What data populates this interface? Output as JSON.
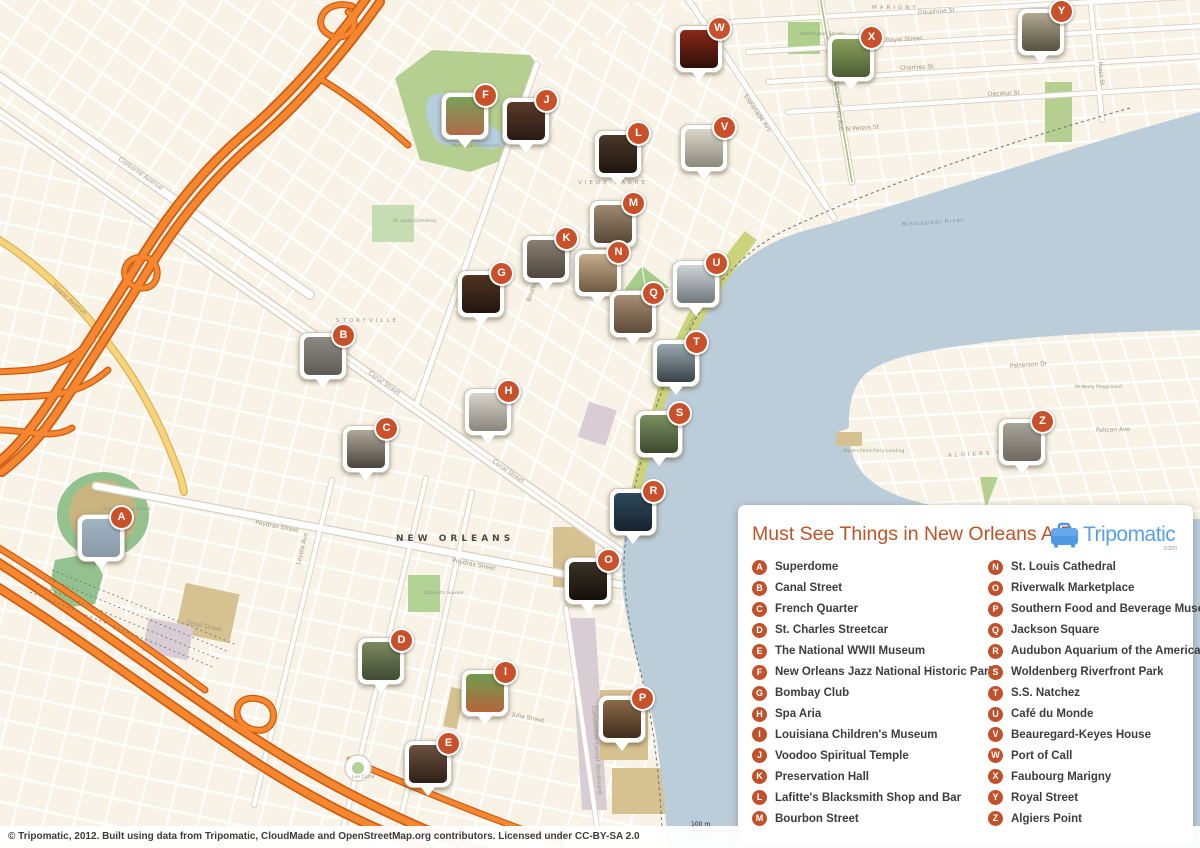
{
  "legend": {
    "title": "Must See Things in New Orleans A-Z",
    "items": [
      {
        "letter": "A",
        "label": "Superdome"
      },
      {
        "letter": "B",
        "label": "Canal Street"
      },
      {
        "letter": "C",
        "label": "French Quarter"
      },
      {
        "letter": "D",
        "label": "St. Charles Streetcar"
      },
      {
        "letter": "E",
        "label": "The National WWII Museum"
      },
      {
        "letter": "F",
        "label": "New Orleans Jazz National Historic Park"
      },
      {
        "letter": "G",
        "label": "Bombay Club"
      },
      {
        "letter": "H",
        "label": "Spa Aria"
      },
      {
        "letter": "I",
        "label": "Louisiana Children's Museum"
      },
      {
        "letter": "J",
        "label": "Voodoo Spiritual Temple"
      },
      {
        "letter": "K",
        "label": "Preservation Hall"
      },
      {
        "letter": "L",
        "label": "Lafitte's Blacksmith Shop and Bar"
      },
      {
        "letter": "M",
        "label": "Bourbon Street"
      },
      {
        "letter": "N",
        "label": "St. Louis Cathedral"
      },
      {
        "letter": "O",
        "label": "Riverwalk Marketplace"
      },
      {
        "letter": "P",
        "label": "Southern Food and Beverage Museum"
      },
      {
        "letter": "Q",
        "label": "Jackson Square"
      },
      {
        "letter": "R",
        "label": "Audubon Aquarium of the Americas"
      },
      {
        "letter": "S",
        "label": "Woldenberg Riverfront Park"
      },
      {
        "letter": "T",
        "label": "S.S. Natchez"
      },
      {
        "letter": "U",
        "label": "Café du Monde"
      },
      {
        "letter": "V",
        "label": "Beauregard-Keyes House"
      },
      {
        "letter": "W",
        "label": "Port of Call"
      },
      {
        "letter": "X",
        "label": "Faubourg Marigny"
      },
      {
        "letter": "Y",
        "label": "Royal Street"
      },
      {
        "letter": "Z",
        "label": "Algiers Point"
      }
    ]
  },
  "logo": {
    "brand": "Tripomatic",
    "tld": ".com"
  },
  "attribution": "© Tripomatic, 2012. Built using data from Tripomatic, CloudMade and OpenStreetMap.org contributors. Licensed under CC-BY-SA 2.0",
  "scale": {
    "metric": "100 m",
    "imperial": "200 ft"
  },
  "markers": [
    {
      "letter": "A",
      "x": 100,
      "y": 537,
      "photo": [
        "#9fb4c4",
        "#8a99a6"
      ]
    },
    {
      "letter": "B",
      "x": 322,
      "y": 355,
      "photo": [
        "#8d8a84",
        "#5f5b55"
      ]
    },
    {
      "letter": "C",
      "x": 365,
      "y": 448,
      "photo": [
        "#b0a79a",
        "#4a443c"
      ]
    },
    {
      "letter": "D",
      "x": 380,
      "y": 660,
      "photo": [
        "#7b8a5d",
        "#3f4a35"
      ]
    },
    {
      "letter": "E",
      "x": 427,
      "y": 763,
      "photo": [
        "#6b5140",
        "#2e2118"
      ]
    },
    {
      "letter": "F",
      "x": 464,
      "y": 115,
      "photo": [
        "#7aa05a",
        "#b06a4a"
      ]
    },
    {
      "letter": "G",
      "x": 480,
      "y": 293,
      "photo": [
        "#50351f",
        "#211510"
      ]
    },
    {
      "letter": "H",
      "x": 487,
      "y": 411,
      "photo": [
        "#d8d4cc",
        "#8a857c"
      ]
    },
    {
      "letter": "I",
      "x": 484,
      "y": 692,
      "photo": [
        "#6f9c4f",
        "#b4643a"
      ]
    },
    {
      "letter": "J",
      "x": 525,
      "y": 120,
      "photo": [
        "#5a3a28",
        "#2a1a12"
      ]
    },
    {
      "letter": "K",
      "x": 545,
      "y": 258,
      "photo": [
        "#8a7f72",
        "#4f463c"
      ]
    },
    {
      "letter": "L",
      "x": 617,
      "y": 153,
      "photo": [
        "#4a3828",
        "#1f150e"
      ]
    },
    {
      "letter": "M",
      "x": 612,
      "y": 223,
      "photo": [
        "#a08a70",
        "#564736"
      ]
    },
    {
      "letter": "N",
      "x": 597,
      "y": 272,
      "photo": [
        "#c4ad8a",
        "#6e5a42"
      ]
    },
    {
      "letter": "O",
      "x": 587,
      "y": 580,
      "photo": [
        "#3a3226",
        "#15100a"
      ]
    },
    {
      "letter": "P",
      "x": 621,
      "y": 718,
      "photo": [
        "#8a6a4a",
        "#3f2d1c"
      ]
    },
    {
      "letter": "Q",
      "x": 632,
      "y": 313,
      "photo": [
        "#a78e72",
        "#5c4a38"
      ]
    },
    {
      "letter": "R",
      "x": 632,
      "y": 511,
      "photo": [
        "#2e4a5c",
        "#16242e"
      ]
    },
    {
      "letter": "S",
      "x": 658,
      "y": 433,
      "photo": [
        "#7a9060",
        "#3d4a30"
      ]
    },
    {
      "letter": "T",
      "x": 675,
      "y": 362,
      "photo": [
        "#9aa8b0",
        "#3a4248"
      ]
    },
    {
      "letter": "U",
      "x": 695,
      "y": 283,
      "photo": [
        "#cfd4d6",
        "#70787c"
      ]
    },
    {
      "letter": "V",
      "x": 703,
      "y": 147,
      "photo": [
        "#d9d5c9",
        "#8c887a"
      ]
    },
    {
      "letter": "W",
      "x": 698,
      "y": 48,
      "photo": [
        "#8a2a1a",
        "#2e0f08"
      ]
    },
    {
      "letter": "X",
      "x": 850,
      "y": 57,
      "photo": [
        "#8aa05c",
        "#4a5c34"
      ]
    },
    {
      "letter": "Y",
      "x": 1040,
      "y": 31,
      "photo": [
        "#b0a890",
        "#56503f"
      ]
    },
    {
      "letter": "Z",
      "x": 1021,
      "y": 441,
      "photo": [
        "#a8a49a",
        "#6e6a5f"
      ]
    }
  ],
  "map_labels": {
    "city": [
      {
        "t": "NEW ORLEANS",
        "x": 396,
        "y": 541,
        "r": 0
      }
    ],
    "water": [
      {
        "t": "Mississippi River",
        "x": 902,
        "y": 226,
        "r": -4
      }
    ],
    "areas": [
      {
        "t": "STORYVILLE",
        "x": 336,
        "y": 322,
        "r": 0
      },
      {
        "t": "VIEUX CARRE",
        "x": 578,
        "y": 184,
        "r": 0
      },
      {
        "t": "MARIGNY",
        "x": 872,
        "y": 9,
        "r": 0
      },
      {
        "t": "ALGIERS POINT",
        "x": 948,
        "y": 457,
        "r": -3
      }
    ],
    "streets": [
      {
        "t": "Canal Street",
        "x": 368,
        "y": 374,
        "r": 35
      },
      {
        "t": "Canal Street",
        "x": 492,
        "y": 462,
        "r": 35
      },
      {
        "t": "Claiborne Avenue",
        "x": 118,
        "y": 160,
        "r": 35
      },
      {
        "t": "Poydras Street",
        "x": 255,
        "y": 524,
        "r": 11
      },
      {
        "t": "Poydras Street",
        "x": 452,
        "y": 562,
        "r": 11
      },
      {
        "t": "Esplanade Ave",
        "x": 744,
        "y": 96,
        "r": 56
      },
      {
        "t": "Elysian Fields Ave",
        "x": 834,
        "y": 78,
        "r": 84
      },
      {
        "t": "Dauphine St",
        "x": 918,
        "y": 14,
        "r": -3
      },
      {
        "t": "Royal Street",
        "x": 886,
        "y": 42,
        "r": -3
      },
      {
        "t": "Chartres St",
        "x": 900,
        "y": 70,
        "r": -3
      },
      {
        "t": "Decatur St",
        "x": 988,
        "y": 96,
        "r": -3
      },
      {
        "t": "N Peters St",
        "x": 846,
        "y": 131,
        "r": -4
      },
      {
        "t": "Press St",
        "x": 1098,
        "y": 62,
        "r": 84
      },
      {
        "t": "Bourbon Street",
        "x": 530,
        "y": 302,
        "r": -70
      },
      {
        "t": "Tulane Avenue",
        "x": 52,
        "y": 286,
        "r": 42
      },
      {
        "t": "Loyola Ave",
        "x": 300,
        "y": 565,
        "r": -76
      },
      {
        "t": "Girod Street",
        "x": 186,
        "y": 624,
        "r": 12
      },
      {
        "t": "Julia Street",
        "x": 512,
        "y": 716,
        "r": 12
      },
      {
        "t": "Convention Center Boulevard",
        "x": 592,
        "y": 706,
        "r": 86
      },
      {
        "t": "Patterson Dr",
        "x": 1010,
        "y": 368,
        "r": -4
      },
      {
        "t": "Pelican Ave",
        "x": 1096,
        "y": 432,
        "r": -2
      }
    ],
    "pois": [
      {
        "t": "Louisiana Superdome",
        "x": 101,
        "y": 510,
        "r": 0
      },
      {
        "t": "Municipal Auditorium",
        "x": 452,
        "y": 147,
        "r": 0
      },
      {
        "t": "Washington Square",
        "x": 800,
        "y": 35,
        "r": 0
      },
      {
        "t": "St. Louis Cemetery",
        "x": 393,
        "y": 222,
        "r": 0
      },
      {
        "t": "Lafayette Square",
        "x": 424,
        "y": 594,
        "r": 0
      },
      {
        "t": "Lee Circle",
        "x": 352,
        "y": 778,
        "r": 0
      },
      {
        "t": "The Moonwalk",
        "x": 688,
        "y": 332,
        "r": -62
      },
      {
        "t": "Algiers Point Ferry Landing",
        "x": 843,
        "y": 452,
        "r": 0
      },
      {
        "t": "McNeely Playground",
        "x": 1075,
        "y": 388,
        "r": 0
      }
    ]
  },
  "colors": {
    "land": "#f8f3e6",
    "water": "#bccdda",
    "motorway": "#f6872f",
    "motorway_casing": "#cc5d14",
    "yellow_road": "#f7d47a",
    "park": "#b5cf90",
    "riverfront": "#ccd47b",
    "accent": "#bf5226",
    "badge": "#c8512b",
    "logo_blue": "#58a0e6"
  }
}
